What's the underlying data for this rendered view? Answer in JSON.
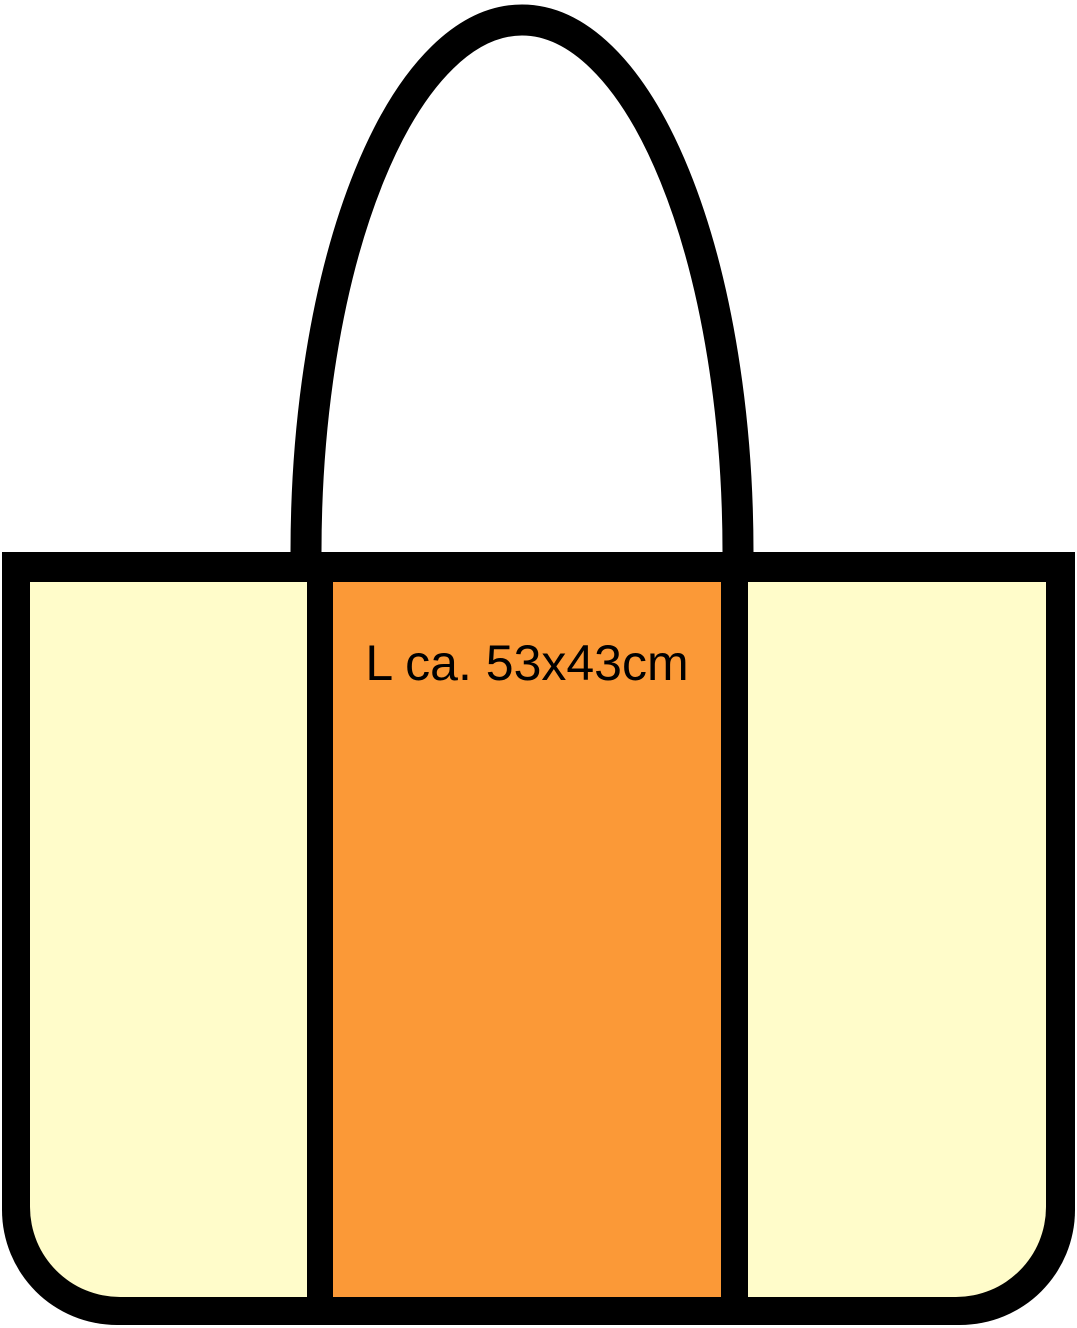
{
  "canvas": {
    "width": "1077",
    "height": "1328",
    "background": "#FFFFFF"
  },
  "colors": {
    "outline": "#000000",
    "body_fill": "#FFFCCA",
    "panel_fill": "#FB9937",
    "label_text": "#000000"
  },
  "bag": {
    "size_label": "L ca. 53x43cm"
  }
}
